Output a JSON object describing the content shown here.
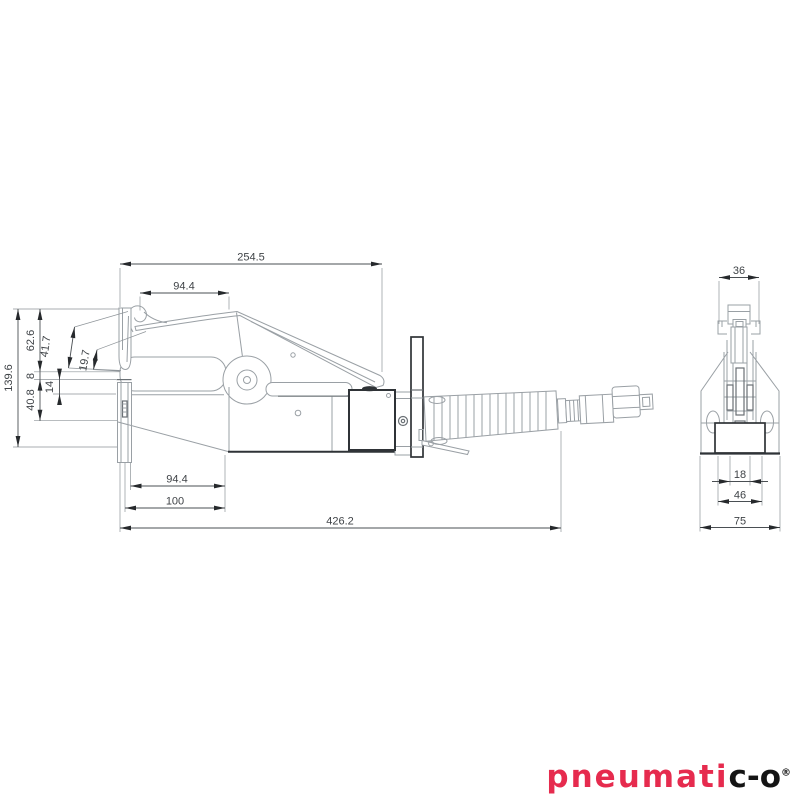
{
  "front_view": {
    "dim_254_5": "254.5",
    "dim_94_4_top": "94.4",
    "dim_139_6": "139.6",
    "dim_62_6": "62.6",
    "dim_41_7": "41.7",
    "dim_19_7": "19.7",
    "dim_8": "8",
    "dim_14": "14",
    "dim_40_8": "40.8",
    "dim_94_4_bottom": "94.4",
    "dim_100": "100",
    "dim_426_2": "426.2"
  },
  "side_view": {
    "dim_36": "36",
    "dim_18": "18",
    "dim_46": "46",
    "dim_75": "75"
  },
  "logo": {
    "text_red": "pneumati",
    "text_black": "c-o",
    "mark": "®"
  },
  "colors": {
    "logo_red": "#e62b4e",
    "logo_black": "#141414",
    "outline_dark": "#2f3337",
    "outline_light": "#9aa0a5",
    "dimension_text": "#3f4347"
  }
}
